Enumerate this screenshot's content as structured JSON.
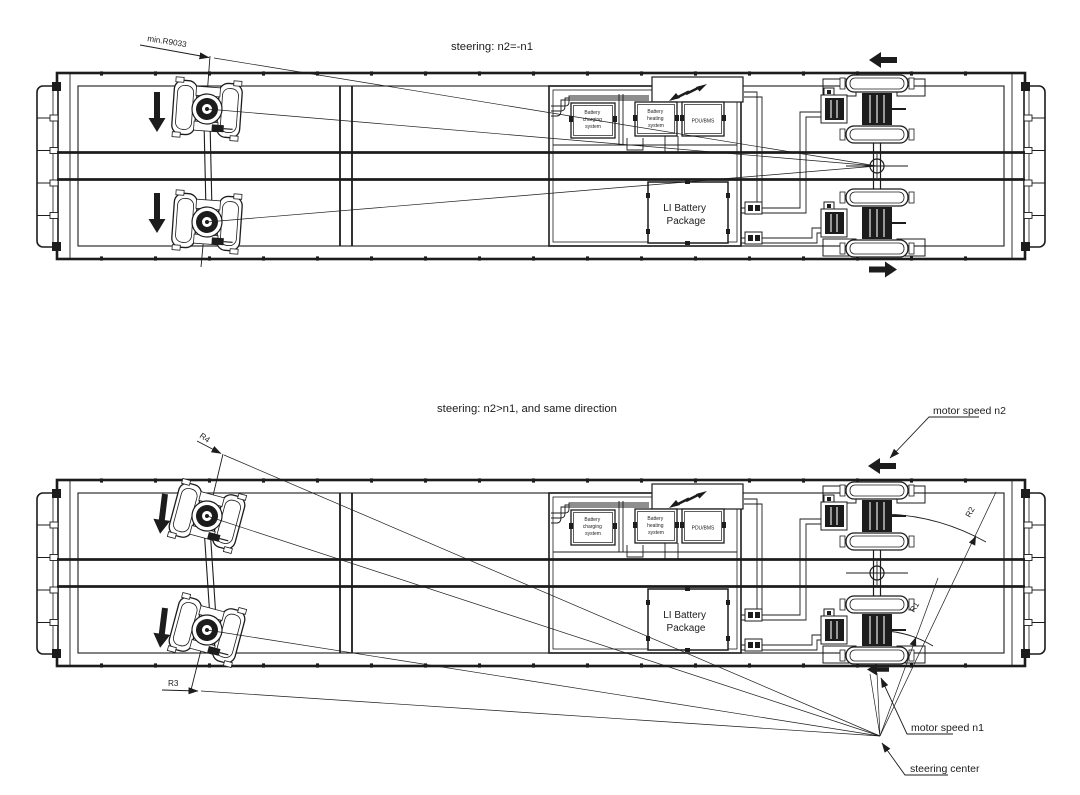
{
  "figure": {
    "background": "#ffffff",
    "ink": "#1c1c1c"
  },
  "top_view": {
    "title": "steering: n2=-n1",
    "min_radius_label": "min.R9033"
  },
  "bottom_view": {
    "title": "steering: n2>n1, and  same direction",
    "labels": {
      "r1": "R1",
      "r2": "R2",
      "r3": "R3",
      "r4": "R4",
      "motor_speed_n2": "motor speed n2",
      "motor_speed_n1": "motor speed n1",
      "steering_center": "steering center"
    }
  },
  "battery_bay": {
    "charging_lines": [
      "Battery",
      "charging",
      "system"
    ],
    "heating_lines": [
      "Battery",
      "heating",
      "system"
    ],
    "pdu_label": "PDU/BMS",
    "li_pack_lines": [
      "LI Battery",
      "Package"
    ]
  }
}
